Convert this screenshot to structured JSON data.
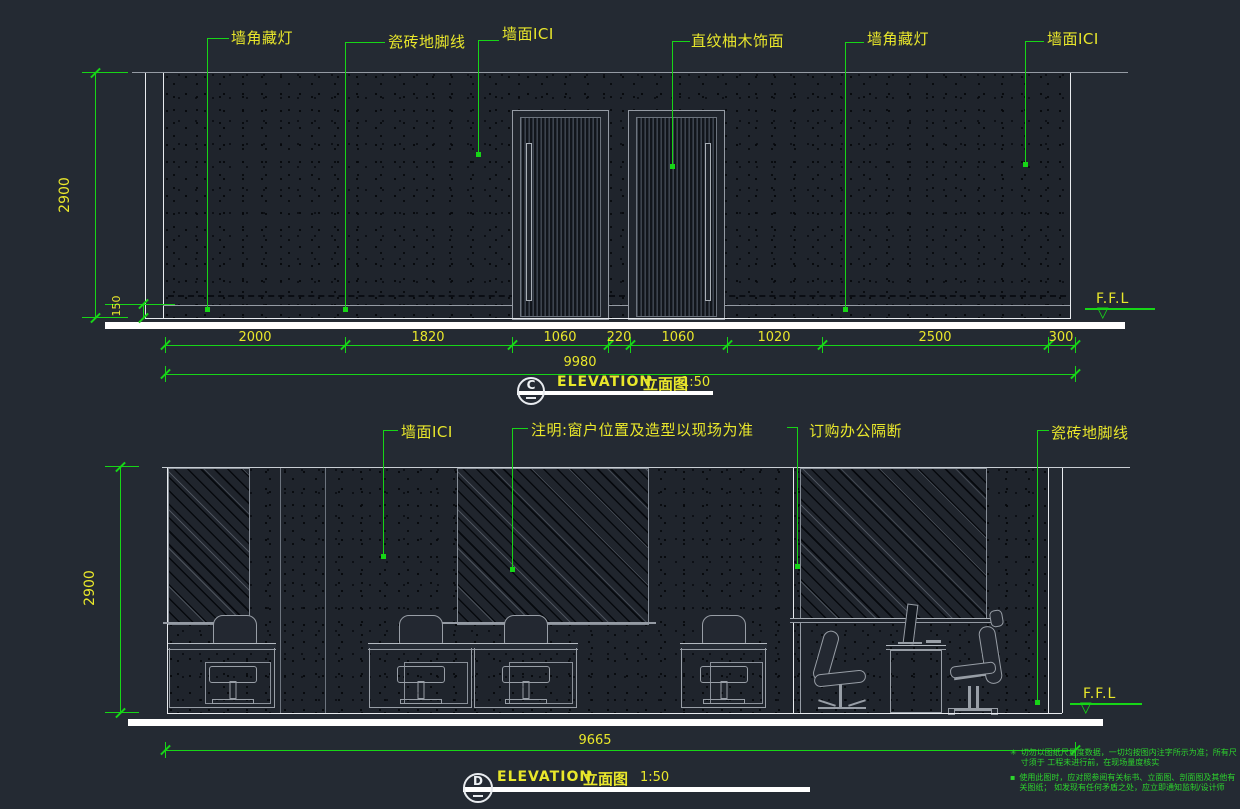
{
  "top": {
    "callouts": [
      "墙角藏灯",
      "瓷砖地脚线",
      "墙面ICI",
      "直纹柚木饰面",
      "墙角藏灯",
      "墙面ICI"
    ],
    "height_dim": "2900",
    "skirting_dim": "150",
    "segment_dims": [
      "2000",
      "1820",
      "1060",
      "220",
      "1060",
      "1020",
      "2500",
      "300"
    ],
    "total_dim": "9980",
    "ffl": "F.F.L",
    "title": {
      "tag": "C",
      "name": "ELEVATION",
      "name_cn": "立面图",
      "scale": "1:50"
    }
  },
  "bottom": {
    "callouts": [
      "墙面ICI",
      "注明:窗户位置及造型以现场为准",
      "订购办公隔断",
      "瓷砖地脚线"
    ],
    "height_dim": "2900",
    "total_dim": "9665",
    "ffl": "F.F.L",
    "title": {
      "tag": "D",
      "name": "ELEVATION",
      "name_cn": "立面图",
      "scale": "1:50"
    }
  },
  "notes": {
    "bullet1": "✳",
    "text1": "切勿以图纸尺量度数据，一切均按图内注字所示为准；所有尺寸须于 工程未进行前，在现场量度核实",
    "bullet2": "▪",
    "text2": "使用此图时，应对照参阅有关标书、立面图、剖面图及其他有关图纸； 如发现有任何矛盾之处，应立即通知监制/设计师"
  },
  "colors": {
    "leader_green": "#17d517",
    "text_yellow": "#e9e72b",
    "note_green": "#2dd42d",
    "background": "#242a33"
  }
}
